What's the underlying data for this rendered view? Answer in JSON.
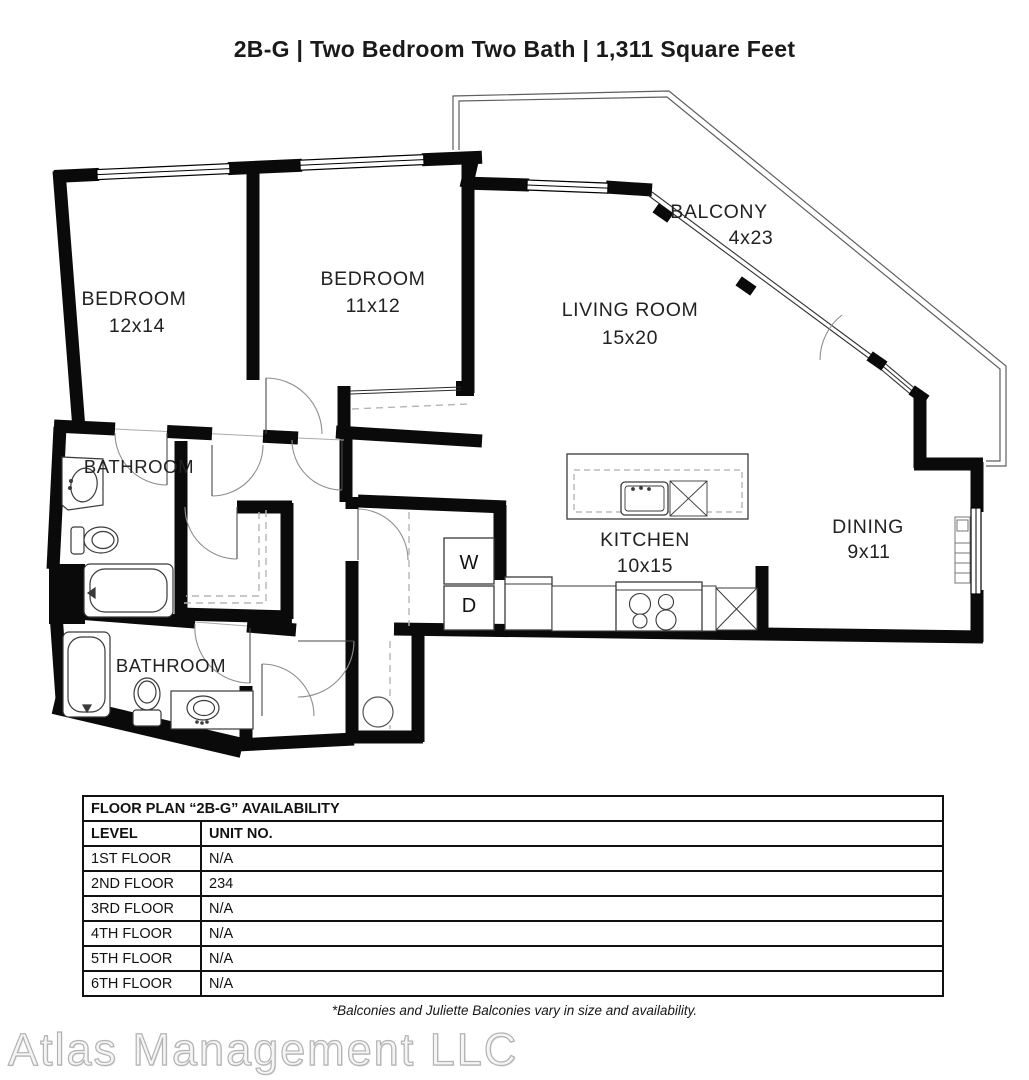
{
  "title": "2B-G | Two Bedroom Two Bath | 1,311 Square Feet",
  "floor_plan": {
    "rooms": {
      "bedroom1": {
        "label": "BEDROOM",
        "dims": "12x14"
      },
      "bedroom2": {
        "label": "BEDROOM",
        "dims": "11x12"
      },
      "living_room": {
        "label": "LIVING ROOM",
        "dims": "15x20"
      },
      "balcony": {
        "label": "BALCONY",
        "dims": "4x23"
      },
      "kitchen": {
        "label": "KITCHEN",
        "dims": "10x15"
      },
      "dining": {
        "label": "DINING",
        "dims": "9x11"
      },
      "bathroom1": {
        "label": "BATHROOM"
      },
      "bathroom2": {
        "label": "BATHROOM"
      }
    },
    "appliances": {
      "washer": "W",
      "dryer": "D"
    }
  },
  "availability_table": {
    "title": "FLOOR PLAN “2B-G” AVAILABILITY",
    "columns": [
      "LEVEL",
      "UNIT NO."
    ],
    "rows": [
      {
        "level": "1ST FLOOR",
        "unit": "N/A"
      },
      {
        "level": "2ND FLOOR",
        "unit": "234"
      },
      {
        "level": "3RD FLOOR",
        "unit": "N/A"
      },
      {
        "level": "4TH FLOOR",
        "unit": "N/A"
      },
      {
        "level": "5TH FLOOR",
        "unit": "N/A"
      },
      {
        "level": "6TH FLOOR",
        "unit": "N/A"
      }
    ]
  },
  "footnote": "*Balconies and Juliette Balconies vary in size and availability.",
  "watermark": "Atlas Management LLC",
  "colors": {
    "wall": "#0a0a0a",
    "label_text": "#222222",
    "table_border": "#111111",
    "watermark_gray": "#b3b3b3"
  }
}
